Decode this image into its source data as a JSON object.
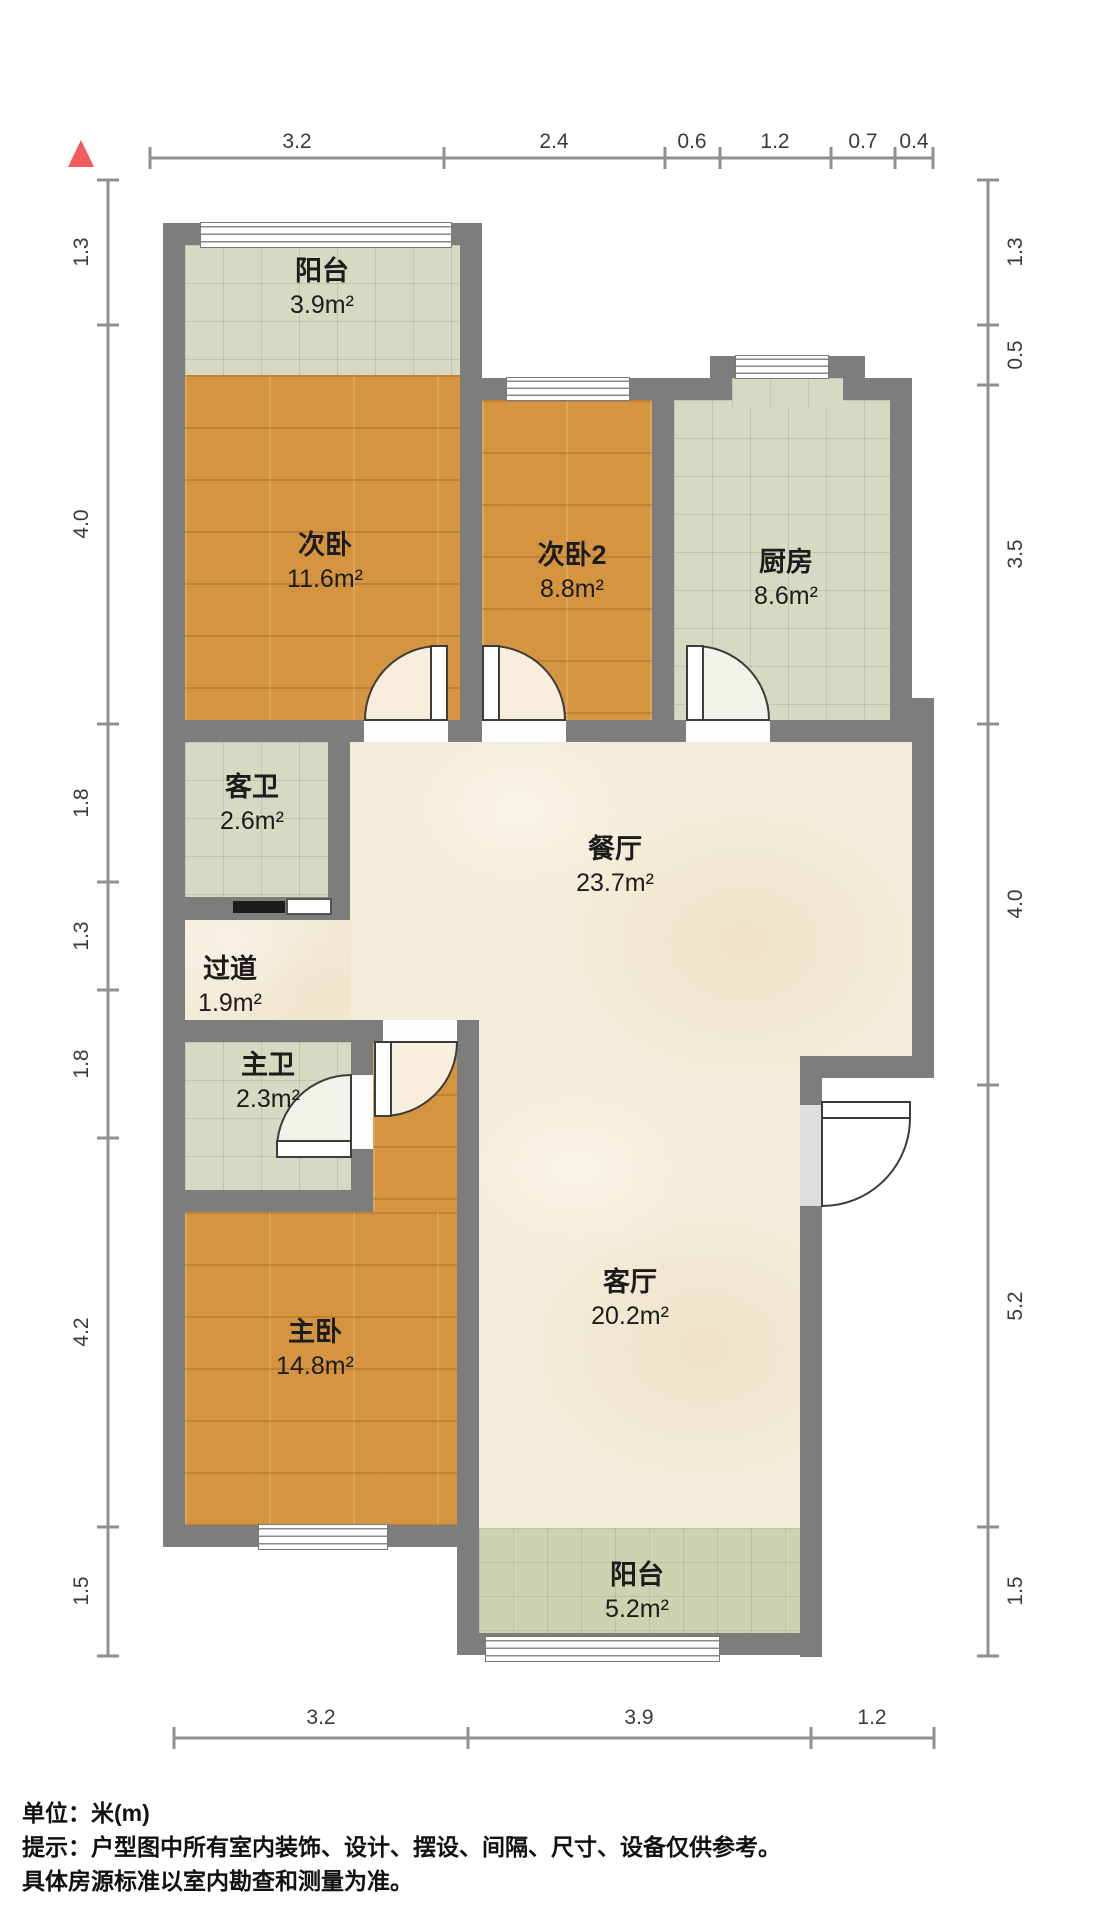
{
  "rooms": {
    "balcony_top": {
      "label": "阳台",
      "area": "3.9m²"
    },
    "bedroom1": {
      "label": "次卧",
      "area": "11.6m²"
    },
    "bedroom2": {
      "label": "次卧2",
      "area": "8.8m²"
    },
    "kitchen": {
      "label": "厨房",
      "area": "8.6m²"
    },
    "guest_bath": {
      "label": "客卫",
      "area": "2.6m²"
    },
    "dining": {
      "label": "餐厅",
      "area": "23.7m²"
    },
    "hallway": {
      "label": "过道",
      "area": "1.9m²"
    },
    "master_bath": {
      "label": "主卫",
      "area": "2.3m²"
    },
    "master_bedroom": {
      "label": "主卧",
      "area": "14.8m²"
    },
    "living": {
      "label": "客厅",
      "area": "20.2m²"
    },
    "balcony_bottom": {
      "label": "阳台",
      "area": "5.2m²"
    }
  },
  "dims": {
    "top": [
      "3.2",
      "2.4",
      "0.6",
      "1.2",
      "0.7",
      "0.4"
    ],
    "left": [
      "1.3",
      "4.0",
      "1.8",
      "1.3",
      "1.8",
      "4.2",
      "1.5"
    ],
    "right": [
      "1.3",
      "0.5",
      "3.5",
      "4.0",
      "5.2",
      "1.5"
    ],
    "bottom": [
      "3.2",
      "3.9",
      "1.2"
    ]
  },
  "footer": {
    "unit": "单位：米(m)",
    "tip1": "提示：户型图中所有室内装饰、设计、摆设、间隔、尺寸、设备仅供参考。",
    "tip2": "具体房源标准以室内勘查和测量为准。"
  },
  "colors": {
    "wall": "#7d7d7d",
    "wood_floor": "#d59540",
    "tile_floor": "#d7d9c3",
    "marble_floor": "#f4ecd8",
    "balcony_floor": "#ccd3b0",
    "north_marker": "#f15b5b"
  }
}
